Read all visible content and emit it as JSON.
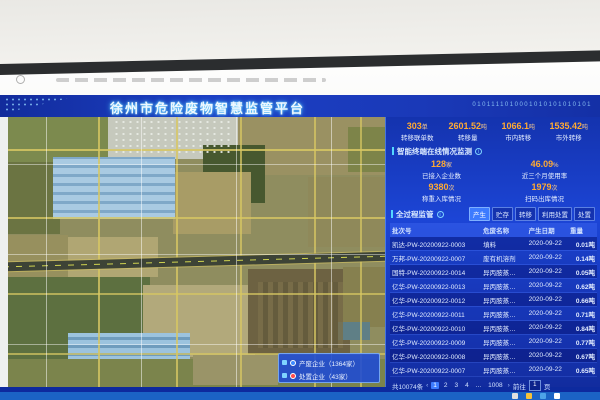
{
  "header": {
    "title": "徐州市危险废物智慧监管平台",
    "binary_text": "0101111010001010101010101"
  },
  "stats_top": {
    "items": [
      {
        "value": "303",
        "unit": "单",
        "label": "转移联单数"
      },
      {
        "value": "2601.52",
        "unit": "吨",
        "label": "转移量"
      },
      {
        "value": "1066.1",
        "unit": "吨",
        "label": "市内转移"
      },
      {
        "value": "1535.42",
        "unit": "吨",
        "label": "市外转移"
      }
    ]
  },
  "terminal_section": {
    "title": "智能终端在线情况监测",
    "stats": [
      {
        "value": "128",
        "unit": "家",
        "label": "已接入企业数"
      },
      {
        "value": "46.09",
        "unit": "%",
        "label": "近三个月使用率"
      },
      {
        "value": "9380",
        "unit": "次",
        "label": "称重入库情况"
      },
      {
        "value": "1979",
        "unit": "次",
        "label": "扫码出库情况"
      }
    ]
  },
  "process_section": {
    "title": "全过程监管",
    "tabs": [
      {
        "label": "产生",
        "active": true
      },
      {
        "label": "贮存",
        "active": false
      },
      {
        "label": "转移",
        "active": false
      },
      {
        "label": "利用处置",
        "active": false
      },
      {
        "label": "处置",
        "active": false
      }
    ],
    "table": {
      "headers": [
        "批次号",
        "危废名称",
        "产生日期",
        "重量"
      ],
      "rows": [
        {
          "batch": "凯达-PW-20200922-0003",
          "name": "填料",
          "date": "2020-09-22",
          "weight": "0.01吨"
        },
        {
          "batch": "万邦-PW-20200922-0007",
          "name": "废有机溶剂",
          "date": "2020-09-22",
          "weight": "0.14吨"
        },
        {
          "batch": "国特-PW-20200922-0014",
          "name": "异丙胺蒸…",
          "date": "2020-09-22",
          "weight": "0.05吨"
        },
        {
          "batch": "亿华-PW-20200922-0013",
          "name": "异丙胺蒸…",
          "date": "2020-09-22",
          "weight": "0.62吨"
        },
        {
          "batch": "亿华-PW-20200922-0012",
          "name": "异丙胺蒸…",
          "date": "2020-09-22",
          "weight": "0.66吨"
        },
        {
          "batch": "亿华-PW-20200922-0011",
          "name": "异丙胺蒸…",
          "date": "2020-09-22",
          "weight": "0.71吨"
        },
        {
          "batch": "亿华-PW-20200922-0010",
          "name": "异丙胺蒸…",
          "date": "2020-09-22",
          "weight": "0.84吨"
        },
        {
          "batch": "亿华-PW-20200922-0009",
          "name": "异丙胺蒸…",
          "date": "2020-09-22",
          "weight": "0.77吨"
        },
        {
          "batch": "亿华-PW-20200922-0008",
          "name": "异丙胺蒸…",
          "date": "2020-09-22",
          "weight": "0.67吨"
        },
        {
          "batch": "亿华-PW-20200922-0007",
          "name": "异丙胺蒸…",
          "date": "2020-09-22",
          "weight": "0.65吨"
        }
      ]
    },
    "pagination": {
      "total": "共10074条",
      "prev": "‹",
      "pages": [
        "1",
        "2",
        "3",
        "4",
        "...",
        "1008"
      ],
      "active_page": "1",
      "next": "›",
      "goto_label": "前往",
      "goto_value": "1",
      "page_unit": "页"
    }
  },
  "map": {
    "legend": [
      {
        "icon_color": "#3d8bff",
        "label": "产废企业（1364家）"
      },
      {
        "icon_color": "#ff4d4d",
        "label": "处置企业（43家）"
      }
    ]
  },
  "icons": {
    "info": "i"
  },
  "taskbar": {
    "icon_colors": [
      "#e0e0e0",
      "#f5c13a",
      "#4da3e8",
      "#ffffff"
    ]
  }
}
